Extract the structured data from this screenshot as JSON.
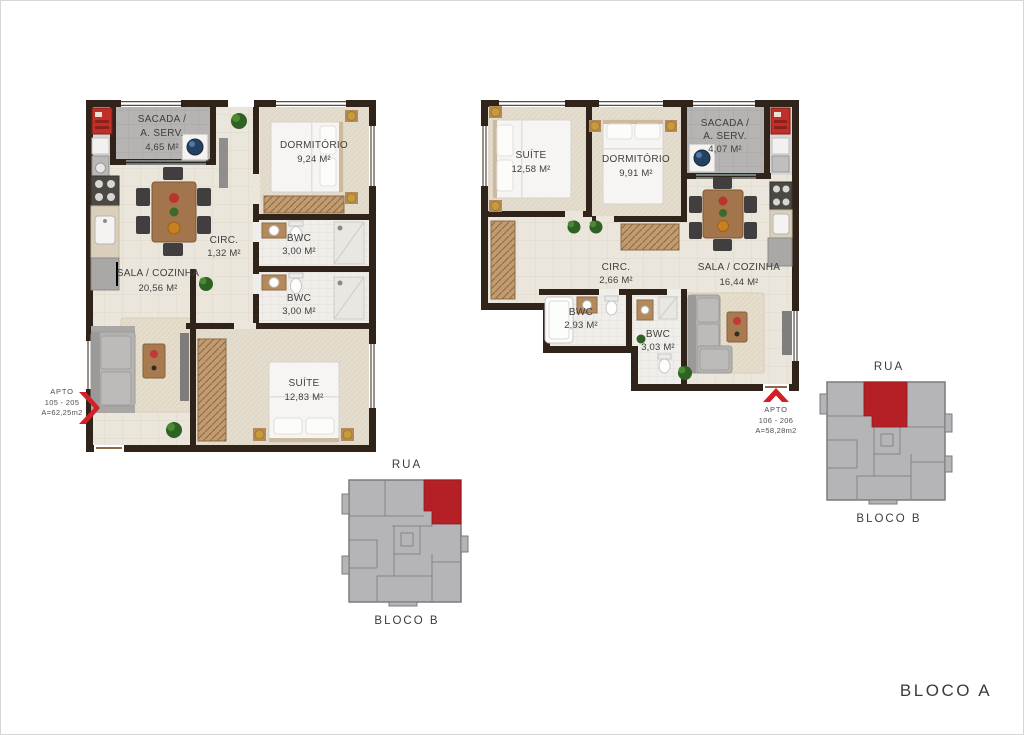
{
  "footer": {
    "block_label": "BLOCO A"
  },
  "colors": {
    "wall": "#30231a",
    "accent_red": "#d22027",
    "keyplan_unit_red": "#b42025",
    "keyplan_gray": "#b5b4b6"
  },
  "plans": [
    {
      "id": "left",
      "apto": {
        "line1": "APTO",
        "line2": "105 - 205",
        "line3": "A=62,25m2"
      },
      "rooms": {
        "sacada": {
          "name_line1": "SACADA /",
          "name_line2": "A. SERV.",
          "area": "4,65 M²"
        },
        "dormitorio": {
          "name": "DORMITÓRIO",
          "area": "9,24 M²"
        },
        "circ": {
          "name": "CIRC.",
          "area": "1,32 M²"
        },
        "bwc1": {
          "name": "BWC",
          "area": "3,00 M²"
        },
        "bwc2": {
          "name": "BWC",
          "area": "3,00 M²"
        },
        "sala": {
          "name": "SALA / COZINHA",
          "area": "20,56 M²"
        },
        "suite": {
          "name": "SUÍTE",
          "area": "12,83 M²"
        }
      },
      "keyplan": {
        "street": "RUA",
        "block": "BLOCO B"
      }
    },
    {
      "id": "right",
      "apto": {
        "line1": "APTO",
        "line2": "106 - 206",
        "line3": "A=58,28m2"
      },
      "rooms": {
        "suite": {
          "name": "SUÍTE",
          "area": "12,58 M²"
        },
        "dormitorio": {
          "name": "DORMITÓRIO",
          "area": "9,91 M²"
        },
        "sacada": {
          "name_line1": "SACADA /",
          "name_line2": "A. SERV.",
          "area": "4,07 M²"
        },
        "circ": {
          "name": "CIRC.",
          "area": "2,66 M²"
        },
        "sala": {
          "name": "SALA / COZINHA",
          "area": "16,44 M²"
        },
        "bwc1": {
          "name": "BWC",
          "area": "2,93 M²"
        },
        "bwc2": {
          "name": "BWC",
          "area": "3,03 M²"
        }
      },
      "keyplan": {
        "street": "RUA",
        "block": "BLOCO B"
      }
    }
  ]
}
